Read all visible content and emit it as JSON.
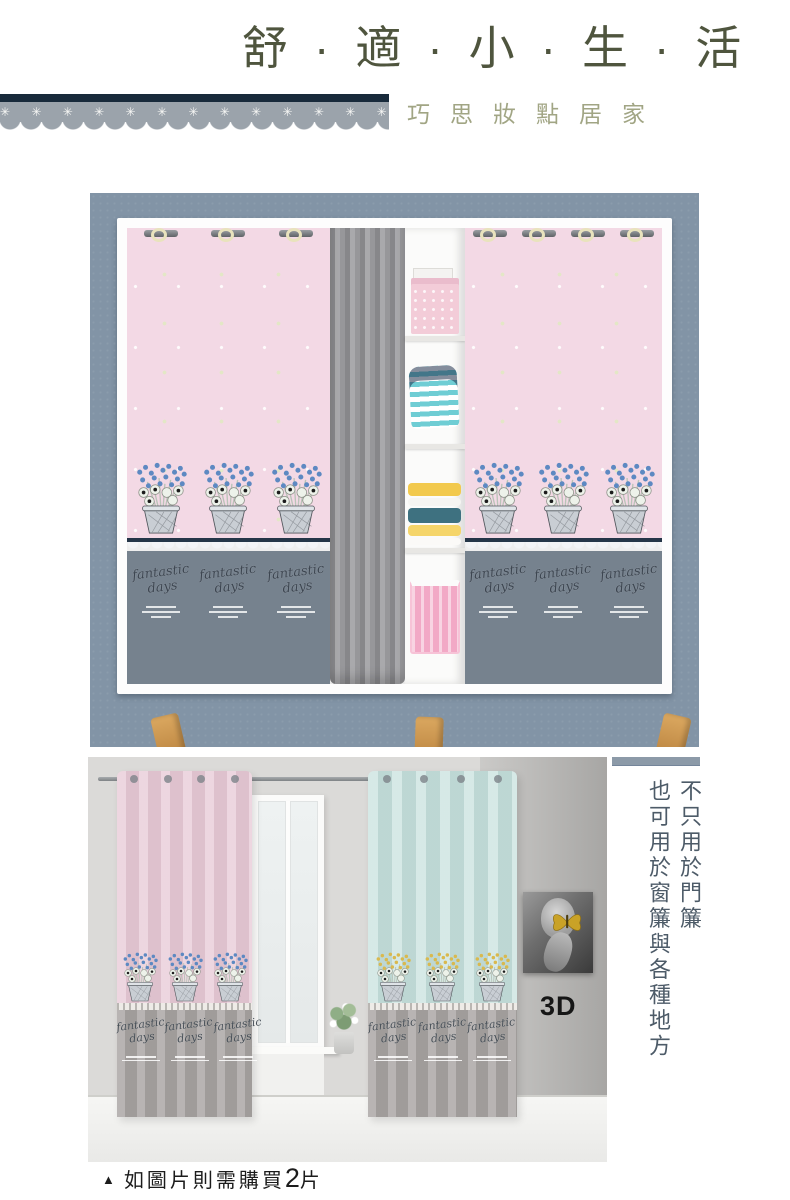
{
  "header": {
    "title": "舒·適·小·生·活",
    "subtitle": "巧思妝點居家",
    "lace_flower_glyph": "✳",
    "lace_flower_count": 17
  },
  "decor": {
    "pattern_script": "fantastic days"
  },
  "second_photo": {
    "label_3d": "3D"
  },
  "side_note": {
    "line1": "不只用於門簾",
    "line2": "也可用於窗簾與各種地方"
  },
  "caption": {
    "marker": "▲",
    "text_before": "如圖片則需購買",
    "quantity": "2",
    "text_after": "片"
  },
  "colors": {
    "title_olive": "#4f553e",
    "subtitle_olive": "#a1a584",
    "lace_navy": "#182a3b",
    "lace_gray": "#9ba3ab",
    "photo1_background": "#8294a6",
    "curtain_pink": "#f3d9e5",
    "curtain_gray_bottom": "#76828e",
    "middle_curtain_gray": "#97979a",
    "wood_leg": "#c8965a",
    "photo2_wall": "#dbdad8",
    "curtain2_pink": "#e7c9d5",
    "curtain2_mint": "#c5e0dc",
    "flower_blue": "#5d89c2",
    "flower_gold": "#d9b94e",
    "side_text": "#4d5b68"
  }
}
